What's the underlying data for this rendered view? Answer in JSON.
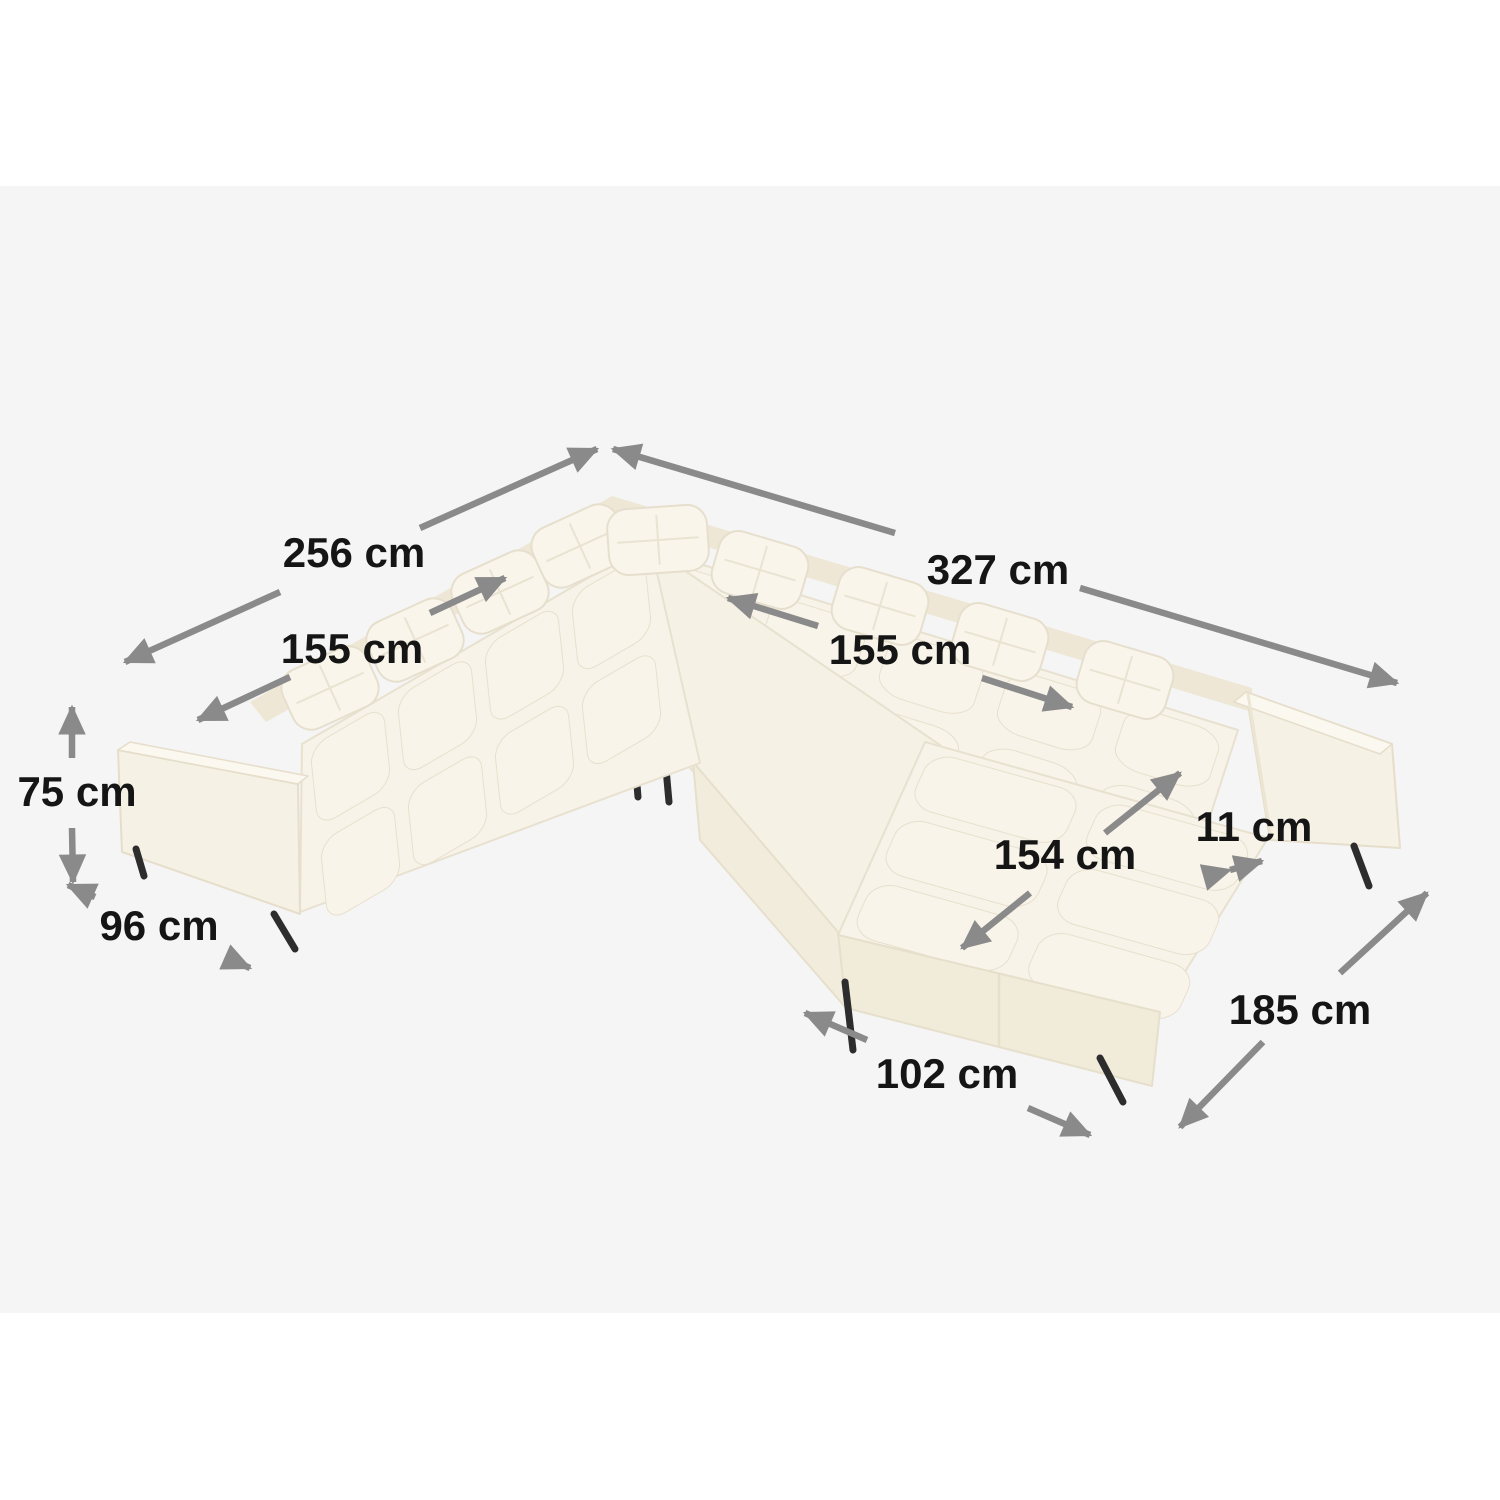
{
  "canvas": {
    "width": 1500,
    "height": 1500,
    "outer_background": "#ffffff",
    "stage_background": "#f5f5f5"
  },
  "illustration": {
    "subject": "u-shaped-tufted-sectional-sofa",
    "fabric_color": "#f7f3e8",
    "fabric_light": "#f9f5eb",
    "fabric_shadow": "#efe8d8",
    "seam_color": "#e8e0cd",
    "leg_color": "#2d2d2d"
  },
  "annotation_style": {
    "arrow_color": "#8a8a8a",
    "text_color": "#151515"
  },
  "dimensions": [
    {
      "id": "back-left-width",
      "label": "256 cm"
    },
    {
      "id": "back-right-width",
      "label": "327 cm"
    },
    {
      "id": "seat-left-length",
      "label": "155 cm"
    },
    {
      "id": "seat-right-length",
      "label": "155 cm"
    },
    {
      "id": "height",
      "label": "75 cm"
    },
    {
      "id": "depth",
      "label": "96 cm"
    },
    {
      "id": "chaise-length",
      "label": "154 cm"
    },
    {
      "id": "armrest-width",
      "label": "11 cm"
    },
    {
      "id": "side-depth",
      "label": "185 cm"
    },
    {
      "id": "chaise-width",
      "label": "102 cm"
    }
  ]
}
